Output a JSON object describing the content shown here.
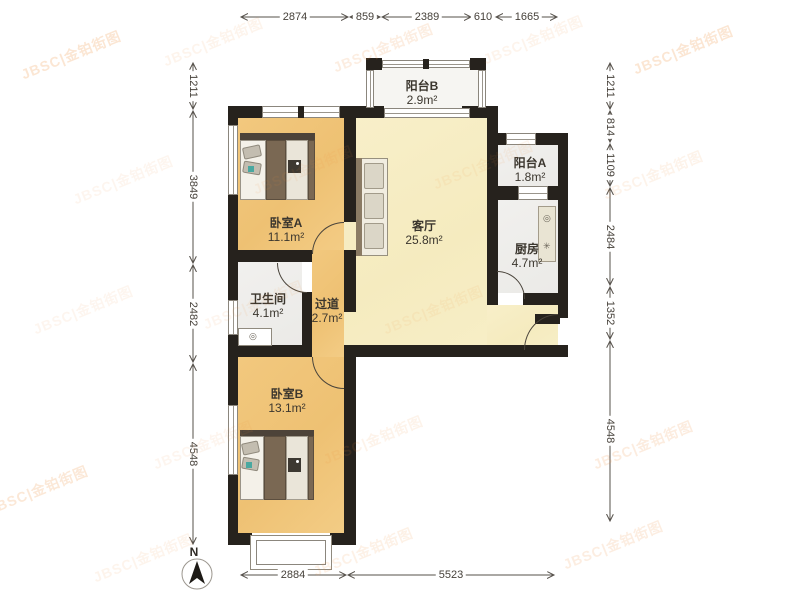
{
  "watermark": {
    "text": "JBSC|金铂街图",
    "color": "#ef8f3c"
  },
  "compass": {
    "label": "N"
  },
  "rooms": [
    {
      "id": "balcony-b",
      "name": "阳台B",
      "area": "2.9m²"
    },
    {
      "id": "bedroom-a",
      "name": "卧室A",
      "area": "11.1m²"
    },
    {
      "id": "living-room",
      "name": "客厅",
      "area": "25.8m²"
    },
    {
      "id": "balcony-a",
      "name": "阳台A",
      "area": "1.8m²"
    },
    {
      "id": "kitchen",
      "name": "厨房",
      "area": "4.7m²"
    },
    {
      "id": "bathroom",
      "name": "卫生间",
      "area": "4.1m²"
    },
    {
      "id": "corridor",
      "name": "过道",
      "area": "2.7m²"
    },
    {
      "id": "bedroom-b",
      "name": "卧室B",
      "area": "13.1m²"
    }
  ],
  "dimensions": {
    "top": [
      "2874",
      "859",
      "2389",
      "610",
      "1665"
    ],
    "left": [
      "1211",
      "3849",
      "2482",
      "4548"
    ],
    "right": [
      "1211",
      "814",
      "1109",
      "2484",
      "1352",
      "4548"
    ],
    "bottom": [
      "2884",
      "5523"
    ]
  },
  "colors": {
    "wall": "#26221d",
    "bedroom_floor": "#efc47a",
    "living_floor": "#f7eec6",
    "service_floor": "#efeeec",
    "dimension_text": "#46413a",
    "watermark": "#ef8f3c"
  }
}
